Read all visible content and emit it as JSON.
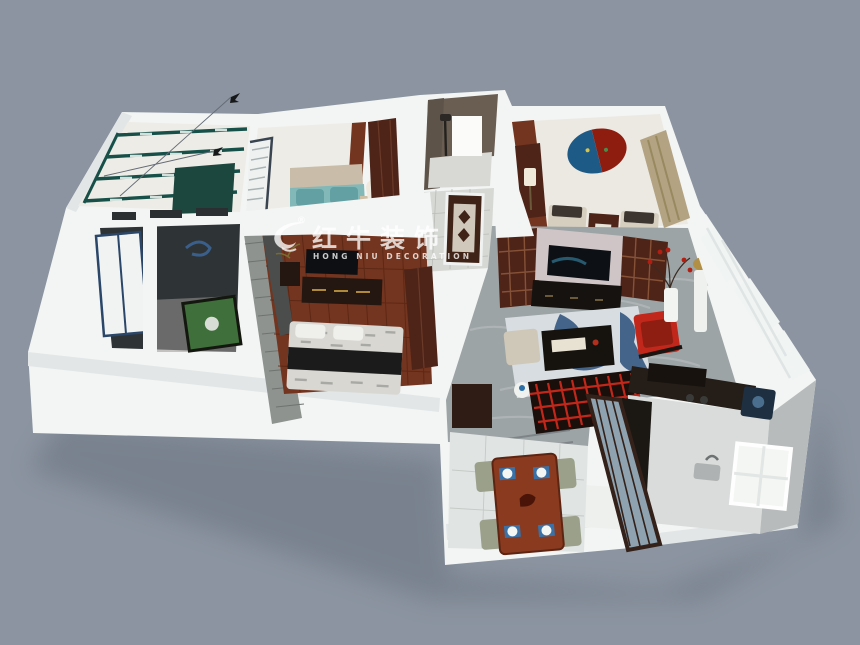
{
  "watermark": {
    "logo": "bull-icon",
    "registered": "®",
    "title": "红牛装饰",
    "subtitle": "HONG NIU DECORATION"
  },
  "palette": {
    "bg": "#8b94a0",
    "shadow": "#59616e",
    "wall": "#f3f5f4",
    "wall-side": "#e2e6e7",
    "wall-dim": "#c7cccf",
    "floor-cream": "#edece6",
    "floor-tile": "#e0e4e2",
    "floor-hall": "#d6d8d4",
    "floor-marble": "#9da4a5",
    "marble-streak": "#b9bfbf",
    "wood-dark": "#4e2418",
    "wood-mid": "#73351f",
    "wood-red": "#8a3a1e",
    "teal": "#175049",
    "teal-cloth": "#1c473e",
    "bed-teal": "#62a0a4",
    "bed-teal-2": "#83b8b8",
    "tan": "#b3a383",
    "beige": "#d6cfbf",
    "red": "#c1271a",
    "art-blue": "#1e5a86",
    "art-red": "#8e1d10",
    "black": "#141414",
    "dark-room": "#2e3335",
    "brick": "#8f938f",
    "brick-dark": "#4a4d4c",
    "concrete": "#9a9893",
    "green-machine": "#3f6f3a",
    "glass": "#8ea2b0",
    "glass-light": "#f0f4f2",
    "navy": "#1d2f40",
    "gold": "#b18f45",
    "rug-white": "#d8dde2",
    "rug-blue": "#2b4f7a",
    "watermark": "rgba(255,255,255,0.78)"
  }
}
